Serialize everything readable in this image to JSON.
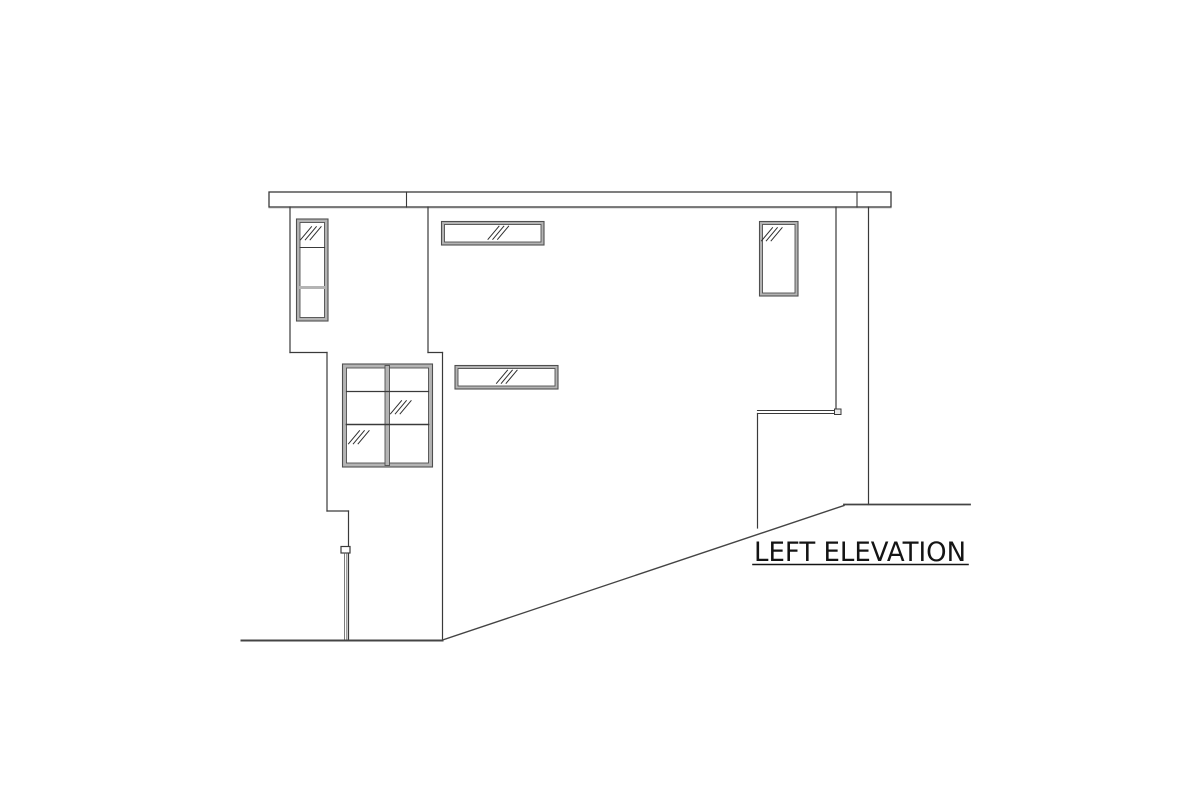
{
  "page": {
    "background": "#ffffff"
  },
  "colors": {
    "line": "#3a3a3a",
    "ground": "#444444",
    "frame_edge": "#4f4f4f",
    "frame_fill": "#b4b4b4",
    "glass": "#ffffff",
    "mark": "#2f2f2f",
    "text": "#141414"
  },
  "label": {
    "text": "LEFT ELEVATION",
    "x": 754,
    "y": 561,
    "size": 27,
    "text_length": 212,
    "underline": {
      "x1": 753,
      "y": 564.5,
      "x2": 968,
      "width": 1.6
    }
  },
  "drawing": {
    "roof_fascia": {
      "x": 269,
      "y": 192,
      "width": 622,
      "height": 15,
      "dividers": [
        406.5,
        857
      ]
    },
    "walls": [
      {
        "name": "left-wall-upper",
        "x1": 290,
        "y1": 207,
        "x2": 290,
        "y2": 352.5
      },
      {
        "name": "left-wall-step-upper",
        "x1": 290,
        "y1": 352.5,
        "x2": 327,
        "y2": 352.5
      },
      {
        "name": "left-wall-middle",
        "x1": 327,
        "y1": 352.5,
        "x2": 327,
        "y2": 511
      },
      {
        "name": "left-wall-step-lower",
        "x1": 327,
        "y1": 511,
        "x2": 348.5,
        "y2": 511
      },
      {
        "name": "left-wall-lower",
        "x1": 348.5,
        "y1": 511,
        "x2": 348.5,
        "y2": 640
      },
      {
        "name": "bay-corner-upper",
        "x1": 428,
        "y1": 207,
        "x2": 428,
        "y2": 352.5
      },
      {
        "name": "bay-corner-step",
        "x1": 428,
        "y1": 352.5,
        "x2": 442.5,
        "y2": 352.5
      },
      {
        "name": "front-corner-lower",
        "x1": 442.5,
        "y1": 352.5,
        "x2": 442.5,
        "y2": 640
      },
      {
        "name": "right-wall-main",
        "x1": 836,
        "y1": 207,
        "x2": 836,
        "y2": 409.5
      },
      {
        "name": "right-wall-far",
        "x1": 868.5,
        "y1": 207,
        "x2": 868.5,
        "y2": 504.5
      },
      {
        "name": "patio-wall-left",
        "x1": 757.5,
        "y1": 413.5,
        "x2": 757.5,
        "y2": 528
      }
    ],
    "ledge": {
      "lines": [
        {
          "x1": 757.5,
          "y1": 410.5,
          "x2": 835,
          "y2": 410.5
        },
        {
          "x1": 757.5,
          "y1": 413.5,
          "x2": 835,
          "y2": 413.5
        }
      ],
      "cap": {
        "x": 834.5,
        "y": 409,
        "w": 6.5,
        "h": 5.5
      }
    },
    "ground": [
      {
        "name": "grade-line-left",
        "x1": 241.5,
        "y1": 640.5,
        "x2": 442.5,
        "y2": 640.5,
        "w": 2
      },
      {
        "name": "grade-line-slope",
        "x1": 442.5,
        "y1": 640,
        "x2": 844,
        "y2": 505.5,
        "w": 1.4
      },
      {
        "name": "grade-line-right",
        "x1": 844,
        "y1": 504.5,
        "x2": 970,
        "y2": 504.5,
        "w": 1.8
      }
    ],
    "downspout": {
      "box": {
        "x": 341,
        "y": 546.5,
        "w": 9,
        "h": 6.5
      },
      "pipes": [
        {
          "x": 344.6,
          "y1": 553,
          "y2": 639.5
        },
        {
          "x": 346.8,
          "y1": 553,
          "y2": 639.5
        }
      ]
    },
    "windows": [
      {
        "name": "window-tall-left",
        "x": 296.5,
        "y": 219,
        "w": 31.5,
        "h": 102,
        "frame": 3.5,
        "h_mullions": [
          {
            "y": 247.5,
            "t": 1.1,
            "c": "line"
          },
          {
            "y": 287.5,
            "t": 3,
            "c": "frame"
          }
        ],
        "v_mullions": [],
        "marks": [
          {
            "cx": 310.5,
            "cy": 233.5
          }
        ]
      },
      {
        "name": "window-clerestory-top",
        "x": 441.5,
        "y": 221.5,
        "w": 102.5,
        "h": 23.5,
        "frame": 3,
        "h_mullions": [],
        "v_mullions": [],
        "marks": [
          {
            "cx": 498,
            "cy": 233
          }
        ]
      },
      {
        "name": "window-right-vertical",
        "x": 759.5,
        "y": 221.5,
        "w": 38.5,
        "h": 74.5,
        "frame": 3,
        "h_mullions": [],
        "v_mullions": [],
        "marks": [
          {
            "cx": 771.5,
            "cy": 234.5
          }
        ]
      },
      {
        "name": "window-large-casement",
        "x": 342.5,
        "y": 364,
        "w": 90,
        "h": 103,
        "frame": 4,
        "h_mullions": [
          {
            "y": 391.5,
            "t": 1.2,
            "c": "line"
          },
          {
            "y": 424.5,
            "t": 1.6,
            "c": "line"
          }
        ],
        "v_mullions": [
          {
            "x": 385,
            "w": 4.5
          }
        ],
        "marks": [
          {
            "cx": 400.5,
            "cy": 407.5
          },
          {
            "cx": 358.5,
            "cy": 437.5
          }
        ]
      },
      {
        "name": "window-clerestory-mid",
        "x": 455,
        "y": 365.5,
        "w": 103,
        "h": 23.5,
        "frame": 3,
        "h_mullions": [],
        "v_mullions": [],
        "marks": [
          {
            "cx": 506.5,
            "cy": 377
          }
        ]
      }
    ]
  }
}
